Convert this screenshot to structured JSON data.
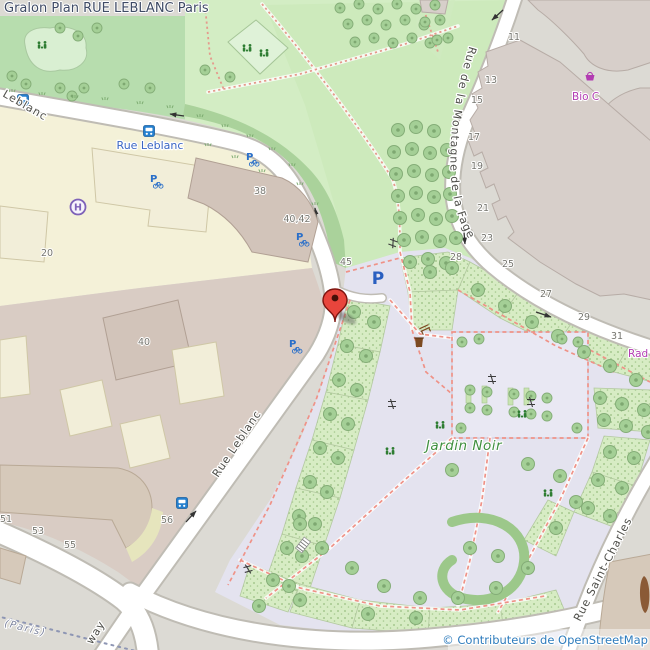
{
  "page": {
    "title": "Gralon Plan RUE LEBLANC Paris"
  },
  "map": {
    "attribution": "© Contributeurs de OpenStreetMap",
    "streets": {
      "leblanc_partial": "Leblanc",
      "leblanc": "Rue Leblanc",
      "montagne_fage": "Rue de la Montagne de la Fage",
      "saint_charles": "Rue Saint-Charles",
      "way_partial": "way"
    },
    "bus_stop": {
      "name": "Rue Leblanc"
    },
    "boundary_label": "(Paris)",
    "park": {
      "name": "Jardin Noir"
    },
    "pois": [
      {
        "name": "Bio C",
        "type": "organic-shop"
      },
      {
        "name": "Rad",
        "type": "shop"
      }
    ],
    "glyphs": {
      "parking_letter": "P",
      "hospital_letter": "H"
    },
    "house_numbers": [
      {
        "value": "38"
      },
      {
        "value": "40,42"
      },
      {
        "value": "45"
      },
      {
        "value": "20"
      },
      {
        "value": "40"
      },
      {
        "value": "51"
      },
      {
        "value": "53"
      },
      {
        "value": "55"
      },
      {
        "value": "56"
      },
      {
        "value": "11"
      },
      {
        "value": "13"
      },
      {
        "value": "15"
      },
      {
        "value": "17"
      },
      {
        "value": "19"
      },
      {
        "value": "21"
      },
      {
        "value": "23"
      },
      {
        "value": "25"
      },
      {
        "value": "27"
      },
      {
        "value": "29"
      },
      {
        "value": "31"
      },
      {
        "value": "28"
      }
    ],
    "icons": [
      "map-marker",
      "bus-stop-icon",
      "bicycle-parking-icon",
      "car-parking-icon",
      "hospital-icon",
      "shop-basket-icon",
      "waste-basket-icon",
      "bench-icon",
      "gate-icon",
      "one-way-arrow-icon",
      "playground-icon",
      "stairs-icon",
      "tree-icon"
    ],
    "colors": {
      "marker_red": "#e8453c",
      "transit_blue": "#2580cf",
      "parking_blue": "#2a5fc0",
      "hospital_purple": "#7e62b8",
      "shop_magenta": "#b23bb2",
      "park_label_green": "#3f8f3f",
      "attribution_blue": "#2e7cbd",
      "title_color": "#3f4b66",
      "garden_lavender": "#e4e3ef",
      "park_green": "#d3edc4",
      "hospital_yellow": "#f4f1d8"
    }
  }
}
